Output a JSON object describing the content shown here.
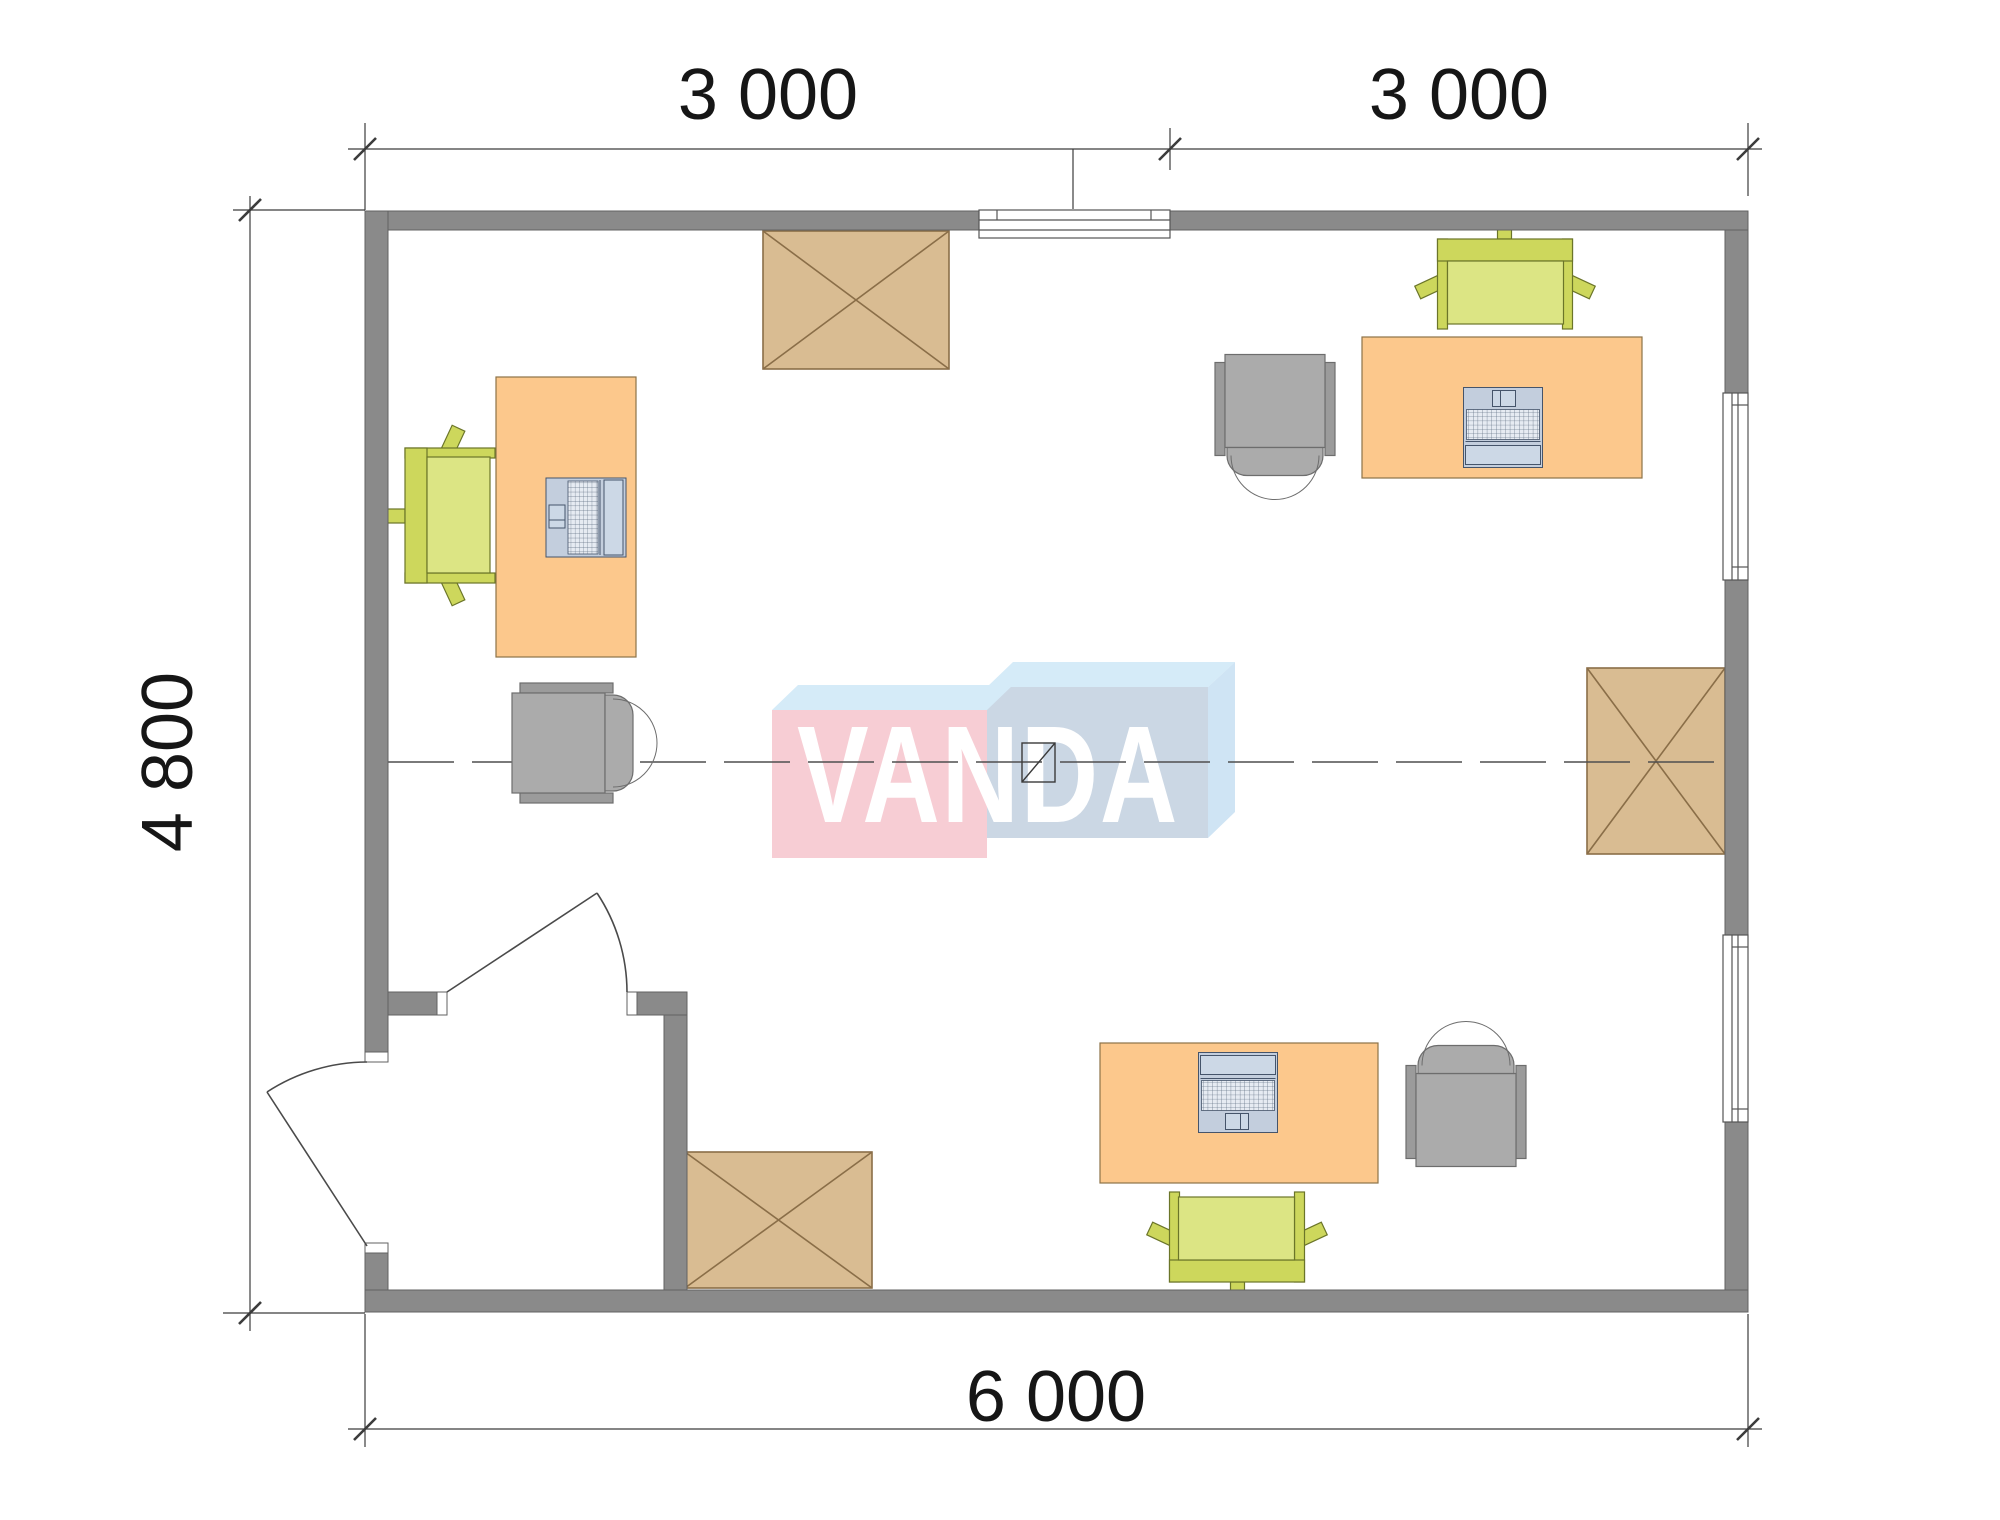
{
  "dimensions": {
    "top_left": "3 000",
    "top_right": "3 000",
    "left": "4 800",
    "bottom": "6 000"
  },
  "logo": {
    "text": "VANDA"
  },
  "icons": {
    "crossed_box": "cabinet-x-symbol",
    "door_arc": "door-swing-symbol",
    "center_marker": "axis-square-symbol"
  },
  "colors": {
    "wall": "#8a8a8a",
    "wall_edge": "#626262",
    "desk": "#fcc88c",
    "desk_edge": "#8d7348",
    "cabinet": "#d9bc92",
    "cabinet_edge": "#8a6e48",
    "chair_green_seat": "#dce584",
    "chair_green_back": "#cdd75c",
    "chair_green_edge": "#6b7529",
    "chair_gray": "#ababab",
    "chair_gray_dark": "#9b9b9b",
    "chair_gray_edge": "#6d6d6d",
    "laptop_body": "#c3cedd",
    "laptop_screen": "#ccd8e6",
    "laptop_edge": "#45546a",
    "logo_pink": "#f7cdd4",
    "logo_blue_top": "#d5ebf8",
    "logo_gray_blue": "#cbd7e4",
    "logo_side": "#cfe4f4",
    "logo_text": "#ffffff",
    "line": "#3c3c3c",
    "dash": "#4f4f4f",
    "text": "#161616",
    "window_line": "#555555"
  }
}
